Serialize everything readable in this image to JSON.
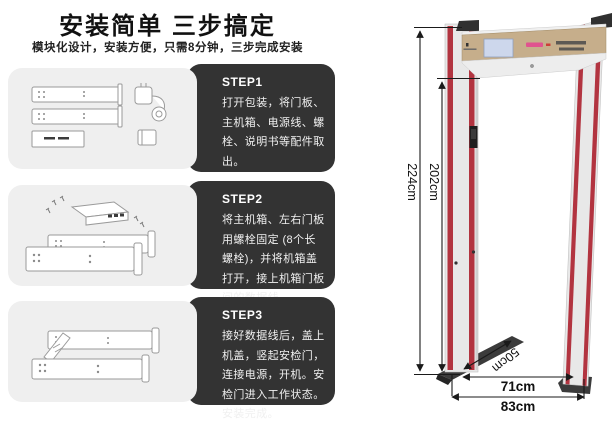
{
  "header": {
    "title": "安装简单 三步搞定",
    "subtitle": "模块化设计，安装方便，只需8分钟，三步完成安装"
  },
  "steps": [
    {
      "label": "STEP1",
      "text": "打开包装，将门板、主机箱、电源线、螺栓、说明书等配件取出。"
    },
    {
      "label": "STEP2",
      "text": "将主机箱、左右门板用螺栓固定 (8个长螺栓)，并将机箱盖打开，接上机箱门板间的数据线。"
    },
    {
      "label": "STEP3",
      "text": "接好数据线后，盖上机盖，竖起安检门，连接电源，开机。安检门进入工作状态。安装完成。"
    }
  ],
  "diagram": {
    "dimensions": {
      "outer_height": "224cm",
      "inner_height": "202cm",
      "inner_width": "71cm",
      "outer_width": "83cm",
      "depth": "50cm"
    }
  },
  "colors": {
    "accent_red": "#b23440",
    "step_box_dark": "#333333",
    "step_box_light": "#efefef",
    "crossbar_beige": "#c6ae8b",
    "lcd_screen": "#cdd7ec",
    "led_pink": "#e2498f"
  }
}
